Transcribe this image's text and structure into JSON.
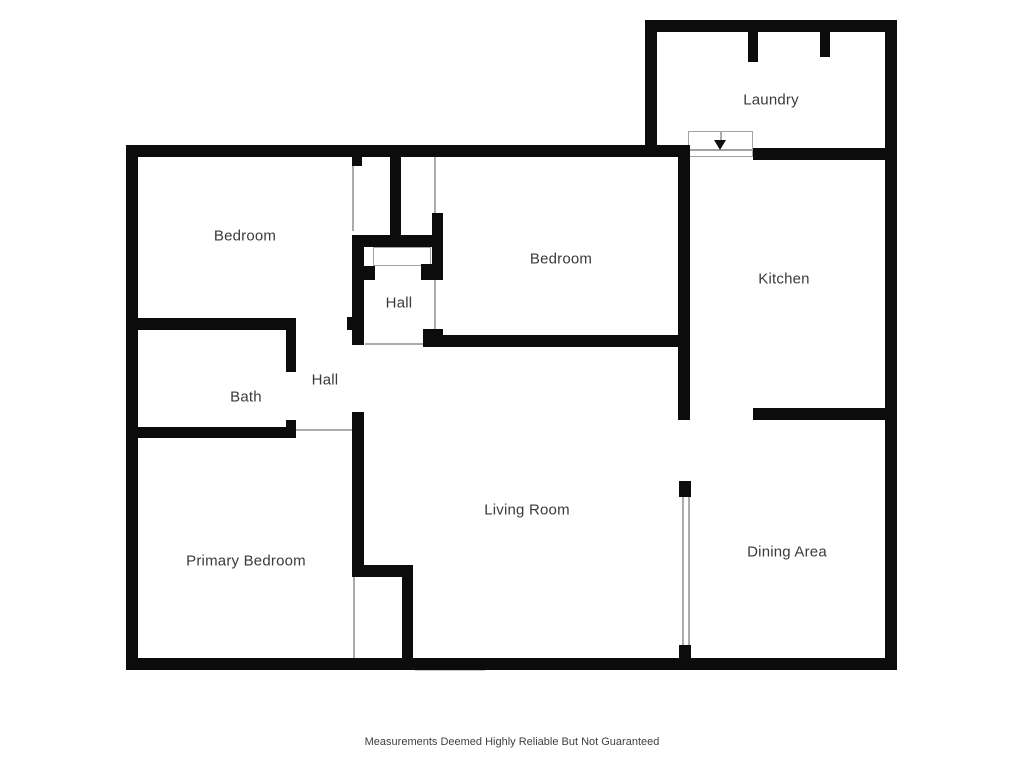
{
  "disclaimer": "Measurements Deemed Highly Reliable But Not Guaranteed",
  "disclaimer_pos": {
    "x": 512,
    "y": 742
  },
  "colors": {
    "wall": "#0c0c0c",
    "window_frame": "#8d8d8d",
    "opening_line": "#ababab",
    "label_text": "#3a3a3a",
    "background": "#ffffff"
  },
  "rooms": [
    {
      "id": "laundry",
      "label": "Laundry",
      "x": 771,
      "y": 100
    },
    {
      "id": "bedroom-left",
      "label": "Bedroom",
      "x": 245,
      "y": 236
    },
    {
      "id": "bedroom-middle",
      "label": "Bedroom",
      "x": 561,
      "y": 259
    },
    {
      "id": "kitchen",
      "label": "Kitchen",
      "x": 784,
      "y": 279
    },
    {
      "id": "hall-upper",
      "label": "Hall",
      "x": 399,
      "y": 303
    },
    {
      "id": "hall-lower",
      "label": "Hall",
      "x": 325,
      "y": 380
    },
    {
      "id": "bath",
      "label": "Bath",
      "x": 246,
      "y": 397
    },
    {
      "id": "primary-bedroom",
      "label": "Primary Bedroom",
      "x": 246,
      "y": 561
    },
    {
      "id": "living-room",
      "label": "Living Room",
      "x": 527,
      "y": 510
    },
    {
      "id": "dining-area",
      "label": "Dining Area",
      "x": 787,
      "y": 552
    }
  ],
  "geometry": {
    "arrow": {
      "x": 720,
      "y": 140
    },
    "walls": [
      [
        126,
        145,
        12,
        525
      ],
      [
        126,
        145,
        564,
        12
      ],
      [
        645,
        20,
        12,
        137
      ],
      [
        645,
        20,
        252,
        12
      ],
      [
        885,
        20,
        12,
        650
      ],
      [
        126,
        658,
        771,
        12
      ],
      [
        753,
        148,
        132,
        12
      ],
      [
        678,
        145,
        12,
        275
      ],
      [
        425,
        335,
        265,
        12
      ],
      [
        423,
        329,
        20,
        18
      ],
      [
        753,
        408,
        144,
        12
      ],
      [
        679,
        481,
        12,
        16
      ],
      [
        679,
        645,
        12,
        25
      ],
      [
        748,
        32,
        10,
        30
      ],
      [
        820,
        32,
        10,
        25
      ],
      [
        390,
        145,
        11,
        97
      ],
      [
        352,
        157,
        10,
        9
      ],
      [
        352,
        235,
        81,
        12
      ],
      [
        432,
        213,
        11,
        67
      ],
      [
        421,
        264,
        11,
        16
      ],
      [
        352,
        235,
        12,
        110
      ],
      [
        364,
        266,
        11,
        14
      ],
      [
        347,
        317,
        6,
        13
      ],
      [
        126,
        318,
        170,
        12
      ],
      [
        286,
        318,
        10,
        54
      ],
      [
        126,
        427,
        170,
        11
      ],
      [
        286,
        420,
        10,
        18
      ],
      [
        352,
        412,
        12,
        160
      ],
      [
        352,
        565,
        61,
        12
      ],
      [
        402,
        577,
        11,
        93
      ]
    ],
    "windows": [
      {
        "x": 263,
        "y": 145.5,
        "w": 64,
        "h": 11,
        "o": "h",
        "div": []
      },
      {
        "x": 502,
        "y": 145.5,
        "w": 105,
        "h": 11,
        "o": "h",
        "div": [
          50
        ]
      },
      {
        "x": 685,
        "y": 20.5,
        "w": 63,
        "h": 11,
        "o": "h",
        "div": []
      },
      {
        "x": 223,
        "y": 658.5,
        "w": 120,
        "h": 11,
        "o": "h",
        "div": [
          56
        ]
      },
      {
        "x": 510,
        "y": 658.5,
        "w": 140,
        "h": 11,
        "o": "h",
        "div": [
          66
        ]
      },
      {
        "x": 697,
        "y": 658.5,
        "w": 120,
        "h": 11,
        "o": "h",
        "div": [
          55
        ]
      },
      {
        "x": 126.5,
        "y": 257,
        "w": 11,
        "h": 56,
        "o": "v",
        "div": []
      },
      {
        "x": 126.5,
        "y": 445,
        "w": 11,
        "h": 60,
        "o": "v",
        "div": []
      },
      {
        "x": 885.5,
        "y": 72,
        "w": 11,
        "h": 56,
        "o": "v",
        "div": []
      },
      {
        "x": 885.5,
        "y": 313,
        "w": 11,
        "h": 90,
        "o": "v",
        "div": []
      },
      {
        "x": 885.5,
        "y": 428,
        "w": 11,
        "h": 49,
        "o": "v",
        "div": []
      },
      {
        "x": 885.5,
        "y": 497,
        "w": 11,
        "h": 66,
        "o": "v",
        "div": []
      }
    ],
    "thin_lines": [
      [
        352,
        166,
        1.5,
        65
      ],
      [
        434,
        157,
        1.5,
        56
      ],
      [
        434,
        280,
        1.5,
        50
      ],
      [
        365,
        343,
        60,
        1.5
      ],
      [
        296,
        429,
        56,
        1.5
      ],
      [
        353,
        577,
        1.5,
        81
      ],
      [
        682,
        497,
        2,
        148
      ],
      [
        688,
        497,
        2,
        148
      ],
      [
        720,
        131,
        1.5,
        10
      ]
    ],
    "thin_rects": [
      [
        373,
        247,
        58,
        19
      ],
      [
        688,
        131,
        65,
        19
      ],
      [
        688,
        150,
        65,
        7
      ]
    ],
    "openings": [
      [
        415,
        657.5,
        70,
        13
      ]
    ]
  }
}
